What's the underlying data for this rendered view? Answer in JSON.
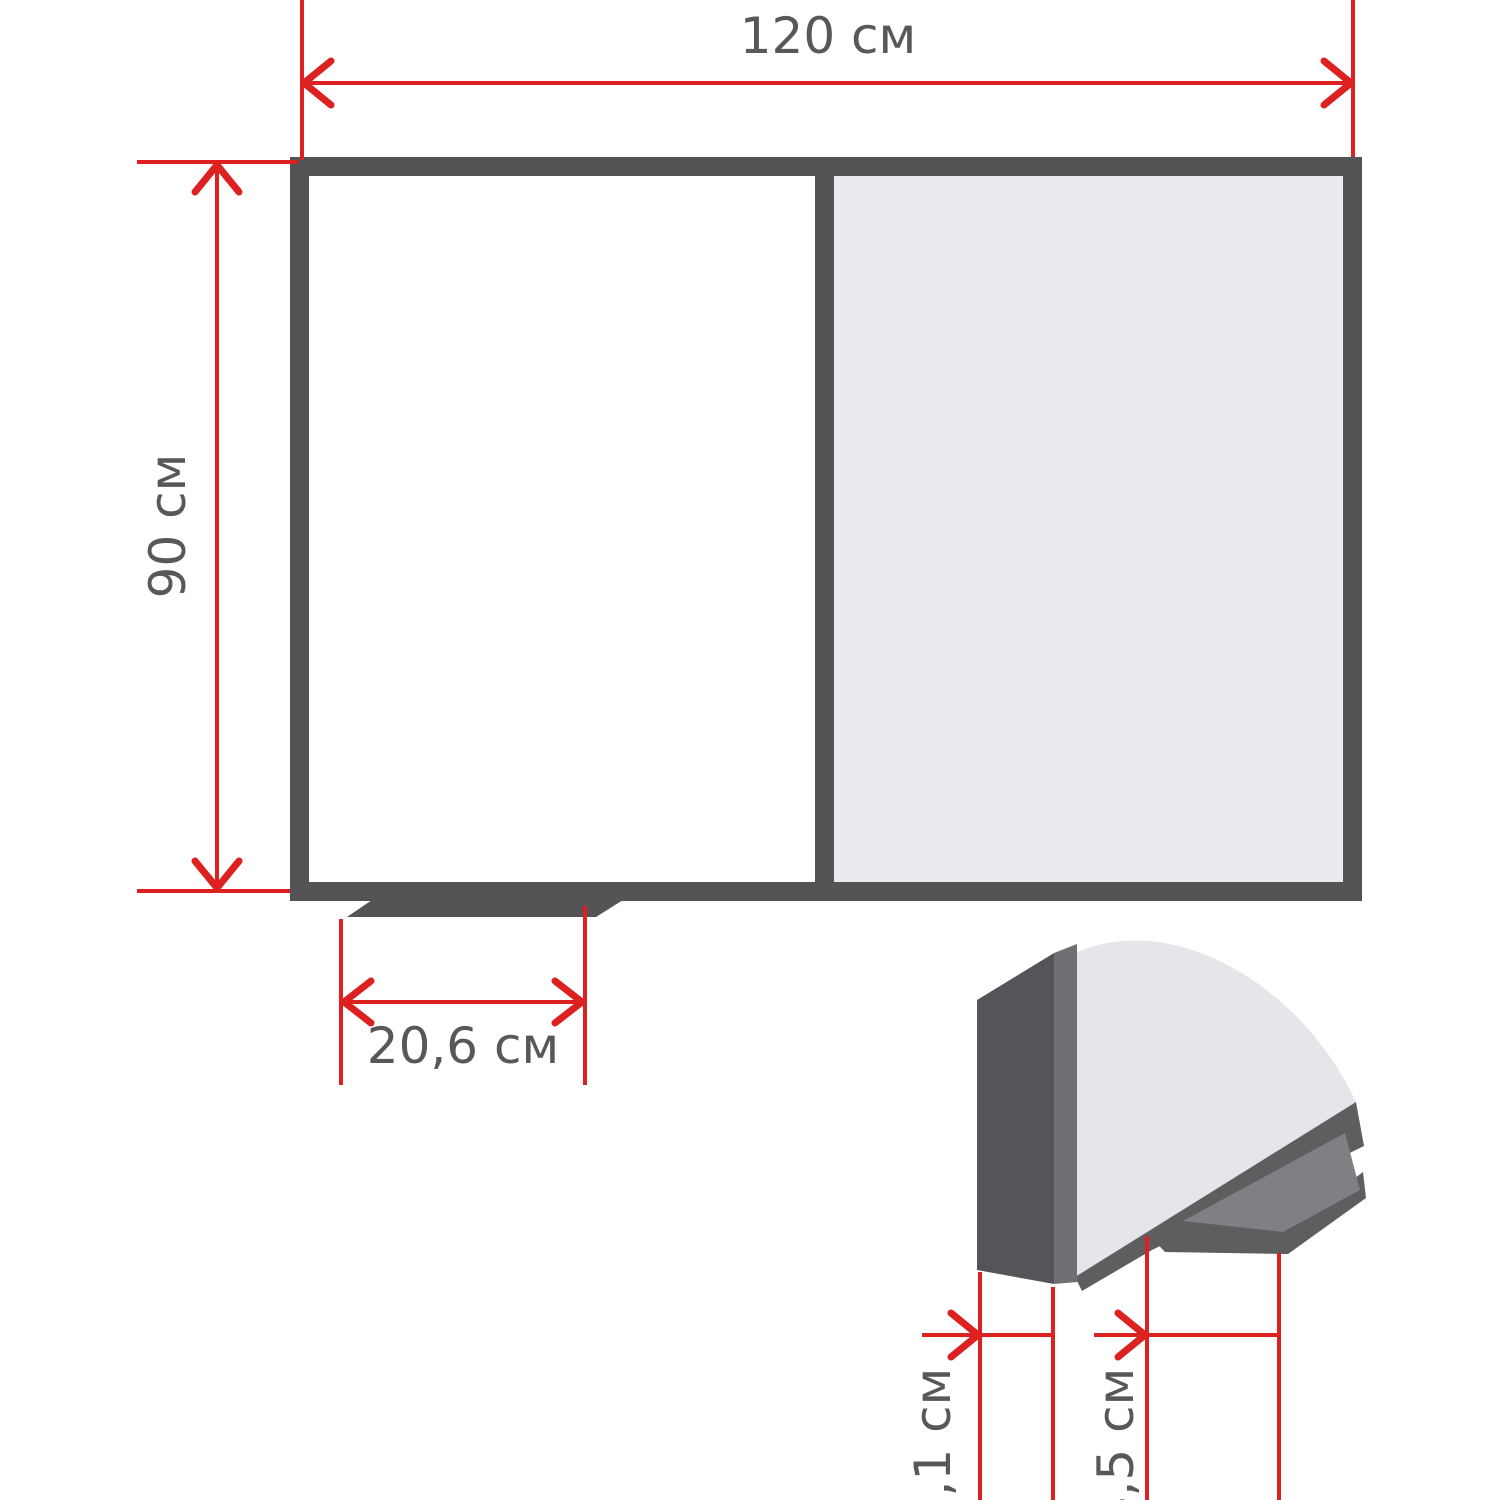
{
  "diagram": {
    "type": "dimension-drawing",
    "subject": "two-panel board with marker tray and corner cross-section detail",
    "unit": "см",
    "labels": {
      "board_width": "120 см",
      "board_height": "90 см",
      "tray_width": "20,6 см",
      "profile_thickness": "2,1 см",
      "tray_depth": "4,5 см"
    },
    "values": {
      "board_width_cm": 120,
      "board_height_cm": 90,
      "tray_width_cm": 20.6,
      "profile_thickness_cm": 2.1,
      "tray_depth_cm": 4.5
    },
    "colors": {
      "dimension_red": "#dd2121",
      "frame_dark_gray": "#545456",
      "frame_side_gray": "#6e7073",
      "tray_mid_gray": "#7e8083",
      "panel_light_gray": "#e9ebee",
      "detail_face_gray": "#e4e6e9",
      "label_text_gray": "#58585b",
      "panel_white": "#ffffff"
    }
  }
}
